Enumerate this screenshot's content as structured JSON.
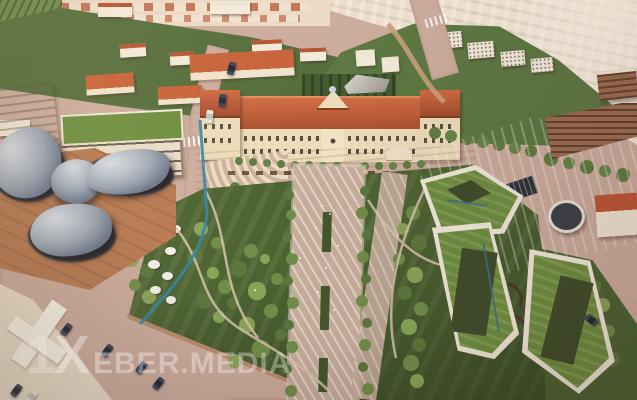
{
  "meta": {
    "type": "aerial-architectural-render",
    "description": "Aerial 3D visualization of a planned campus: central classical building with red roof, terraced plaza, large landscaped park with diagonal promenade, silver organic dome pavilions on the left, angular green-roof courtyard buildings on the right, surrounded by forest and city blocks"
  },
  "watermark": {
    "prefix": "1",
    "initial": "X",
    "text": "EBER.MEDIA",
    "full_text": "1XEBER.MEDIA",
    "color": "#ffffff",
    "opacity_pct": 30
  },
  "palette": {
    "road": "#cbab9c",
    "promenade": "#c6ad9c",
    "plaza": "#e6d2ba",
    "park": "#49612f",
    "tree": "#6d8c46",
    "treeLight": "#86a355",
    "treeDark": "#55703a",
    "forest": "#516b38",
    "city": "#ead9c6",
    "cityLight": "#f4e9d8",
    "cream": "#ecdcba",
    "roof": "#b5502f",
    "groof": "#6b8c3c",
    "whiteBand": "#f0e9da",
    "blob": "#9aa4b2",
    "blobHi": "#d6dce4",
    "blobDark": "#505a6c",
    "plinth": "#262c36",
    "terra": "#b5774f",
    "glass": "#3c6c8c",
    "canal": "#2f86a6",
    "car": "#1f2635"
  }
}
